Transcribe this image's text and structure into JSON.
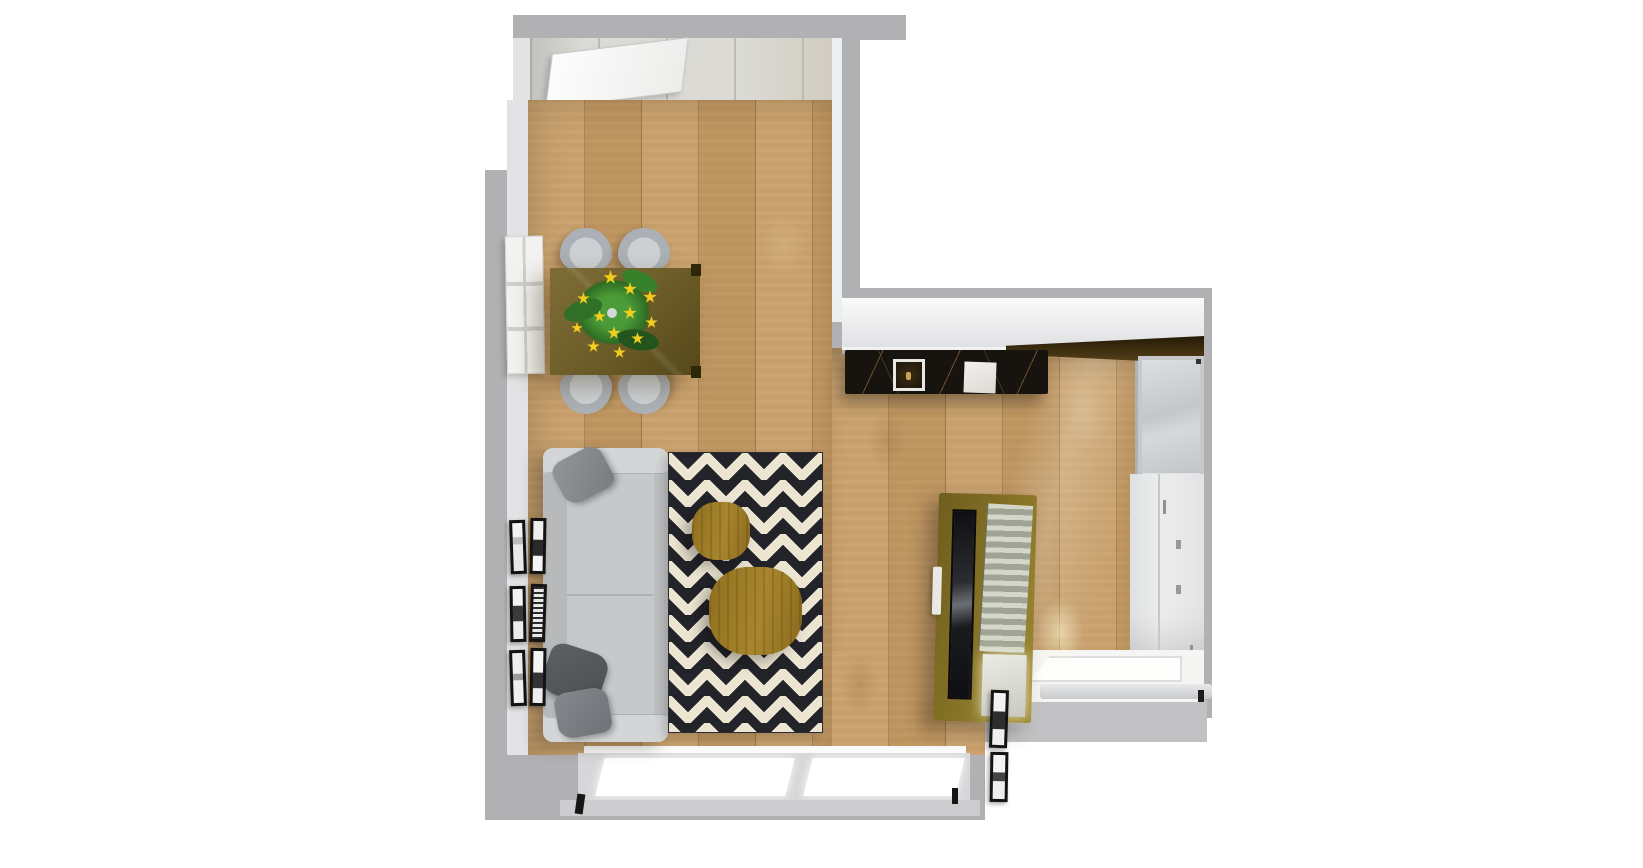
{
  "scene": {
    "title": "Top-down 3D apartment floor plan render",
    "rooms": {
      "entry": {
        "label": "Entry hallway"
      },
      "living_dining": {
        "label": "Living and dining room"
      },
      "kitchen": {
        "label": "Kitchen corridor"
      }
    },
    "objects": {
      "entry_door": {
        "label": "Open entry door",
        "color": "#f5f5f5"
      },
      "radiator_panel": {
        "label": "White wall radiator panel",
        "color": "#f2f2f0"
      },
      "dining_table": {
        "label": "Dark wood dining table",
        "color": "#6f5f2b"
      },
      "dining_chair": {
        "label": "Gray dining chair",
        "color": "#b4b9be"
      },
      "flower_plant": {
        "label": "Plant with yellow flowers",
        "color": "#3f8a2f"
      },
      "sofa": {
        "label": "Gray sofa with pillows",
        "color": "#c6c8ca"
      },
      "wall_frames_left": {
        "label": "Six leaning picture frames",
        "color": "#131313"
      },
      "rug": {
        "label": "Black and white chevron rug",
        "color": "#ece5d2"
      },
      "coffee_table_small": {
        "label": "Small round coffee table",
        "color": "#a8862e"
      },
      "coffee_table_large": {
        "label": "Large round coffee table",
        "color": "#a8862e"
      },
      "kitchen_counter": {
        "label": "Black marble countertop",
        "color": "#17140f"
      },
      "kitchen_sink": {
        "label": "Kitchen sink",
        "color": "#2a2013"
      },
      "kitchen_hob": {
        "label": "White hob board",
        "color": "#eceae6"
      },
      "upper_cabinets": {
        "label": "White upper cabinets",
        "color": "#eeeeee"
      },
      "dark_upper_cabinets": {
        "label": "Dark wood upper cabinets",
        "color": "#4f3a14"
      },
      "kitchen_window": {
        "label": "Kitchen window",
        "color": "#cfd2d6"
      },
      "tall_cabinets": {
        "label": "Tall white cabinet run",
        "color": "#e9eaeb"
      },
      "tv_unit": {
        "label": "Wooden TV media unit with slatted panel",
        "color": "#8b7728"
      },
      "wall_frames_right": {
        "label": "Two leaning picture frames",
        "color": "#131313"
      },
      "balcony_sill": {
        "label": "Balcony door sill",
        "color": "#f5f5f4"
      },
      "bottom_windows": {
        "label": "Floor-to-ceiling windows",
        "color": "#ffffff"
      }
    },
    "palette": {
      "page_bg": "#ffffff",
      "wall": "#b1b1b3",
      "wall_inner": "#e3e3e5",
      "floor_wood": "#c79d66",
      "entry_tile": "#dbdad5",
      "rug_black": "#23232a",
      "rug_cream": "#ece5d2",
      "flower_yellow": "#f3cd1e",
      "plant_green": "#3f8a2f"
    }
  }
}
